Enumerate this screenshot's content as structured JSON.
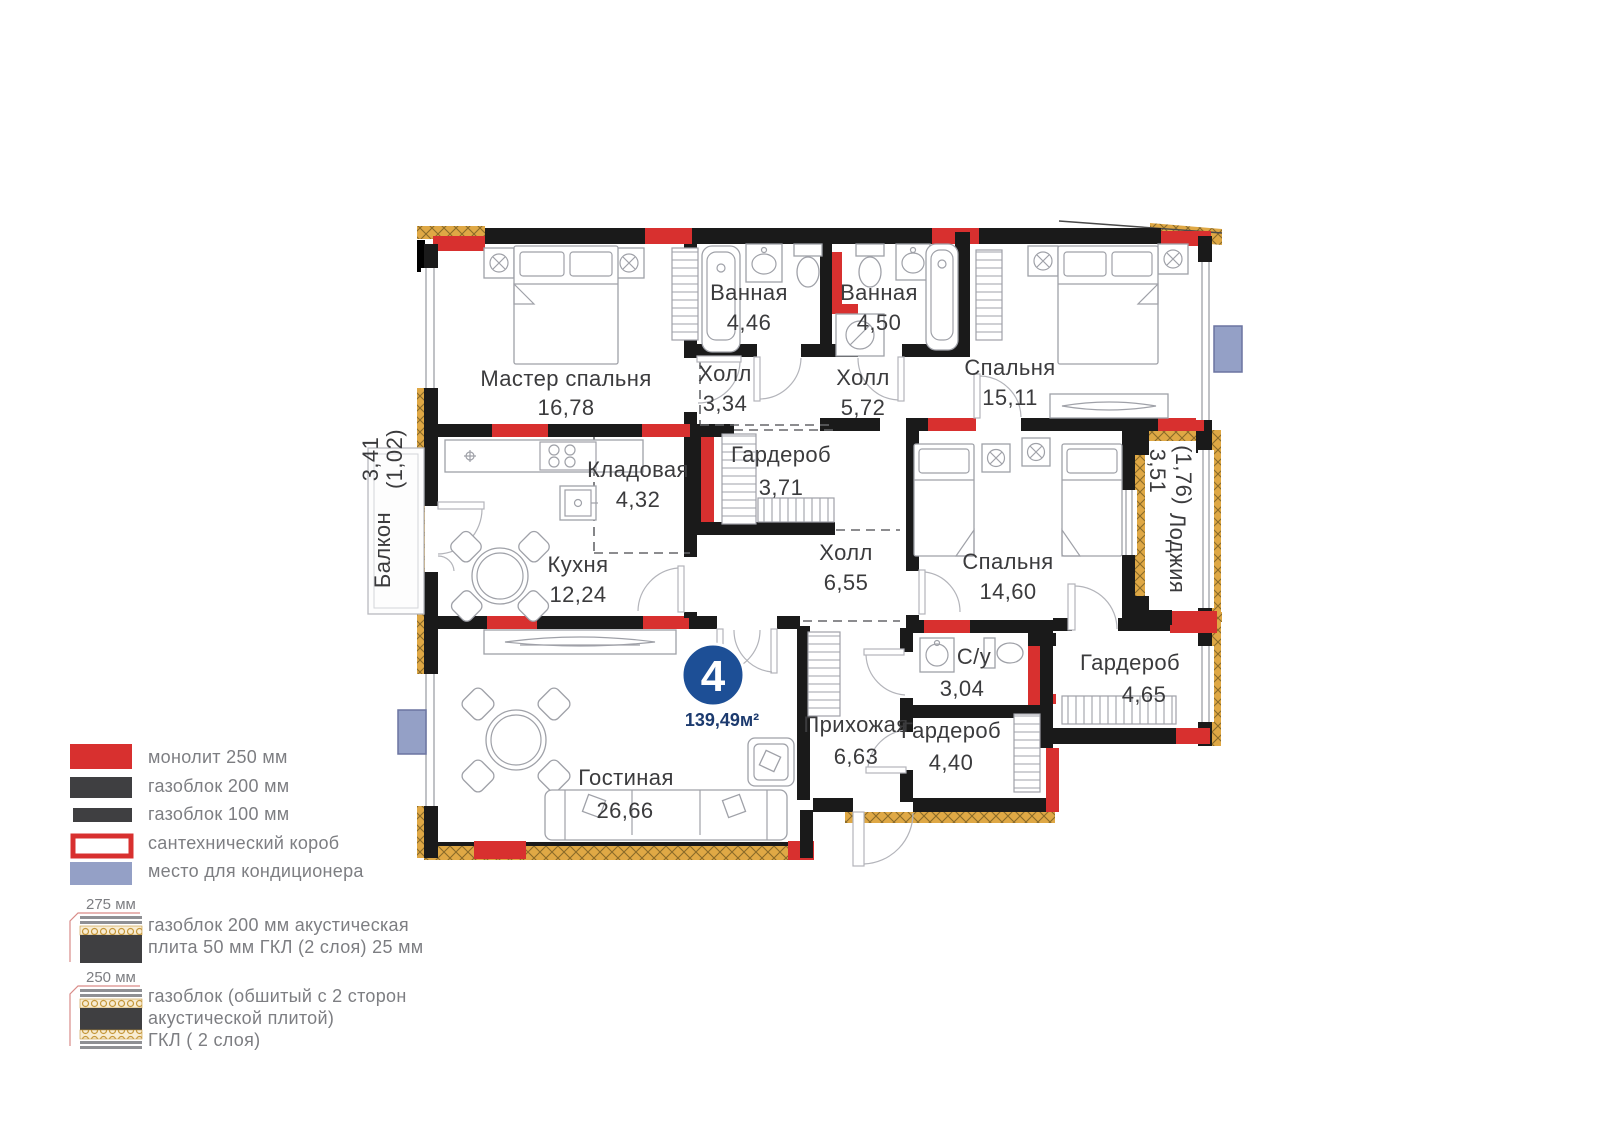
{
  "unit": {
    "number": "4",
    "area_label": "139,49м²"
  },
  "rooms": [
    {
      "name": "Мастер спальня",
      "area": "16,78"
    },
    {
      "name": "Ванная",
      "area": "4,46"
    },
    {
      "name": "Ванная",
      "area": "4,50"
    },
    {
      "name": "Спальня",
      "area": "15,11"
    },
    {
      "name": "Холл",
      "area": "3,34"
    },
    {
      "name": "Холл",
      "area": "5,72"
    },
    {
      "name": "Кладовая",
      "area": "4,32"
    },
    {
      "name": "Гардероб",
      "area": "3,71"
    },
    {
      "name": "Холл",
      "area": "6,55"
    },
    {
      "name": "Спальня",
      "area": "14,60"
    },
    {
      "name": "Кухня",
      "area": "12,24"
    },
    {
      "name": "Балкон",
      "area": "3,41",
      "area_reduced": "(1,02)"
    },
    {
      "name": "Лоджия",
      "area": "3,51",
      "area_reduced": "(1,76)"
    },
    {
      "name": "Гостиная",
      "area": "26,66"
    },
    {
      "name": "Прихожая",
      "area": "6,63"
    },
    {
      "name": "С/у",
      "area": "3,04"
    },
    {
      "name": "Гардероб",
      "area": "4,40"
    },
    {
      "name": "Гардероб",
      "area": "4,65"
    }
  ],
  "legend": {
    "items": [
      {
        "label": "монолит 250 мм",
        "swatch": "monolith",
        "color": "#d8302f"
      },
      {
        "label": "газоблок 200 мм",
        "swatch": "gasblock-200",
        "color": "#3f3f41"
      },
      {
        "label": "газоблок 100 мм",
        "swatch": "gasblock-100",
        "color": "#3f3f41"
      },
      {
        "label": "сантехнический короб",
        "swatch": "plumbing-box",
        "color": "#d8302f"
      },
      {
        "label": "место для кондиционера",
        "swatch": "ac-place",
        "color": "#94a0c6"
      }
    ],
    "wall_types": [
      {
        "thickness": "275 мм",
        "lines": [
          "газоблок 200 мм акустическая",
          "плита 50 мм ГКЛ (2 слоя) 25 мм",
          ""
        ]
      },
      {
        "thickness": "250 мм",
        "lines": [
          "газоблок (обшитый с 2 сторон",
          "акустической плитой)",
          "ГКЛ ( 2 слоя)"
        ]
      }
    ]
  },
  "colors": {
    "wall": "#1a1a1a",
    "monolith_red": "#d8302f",
    "insulation_gold": "#dfa845",
    "badge_blue": "#1d4f96",
    "ac_blue": "#94a0c6"
  }
}
